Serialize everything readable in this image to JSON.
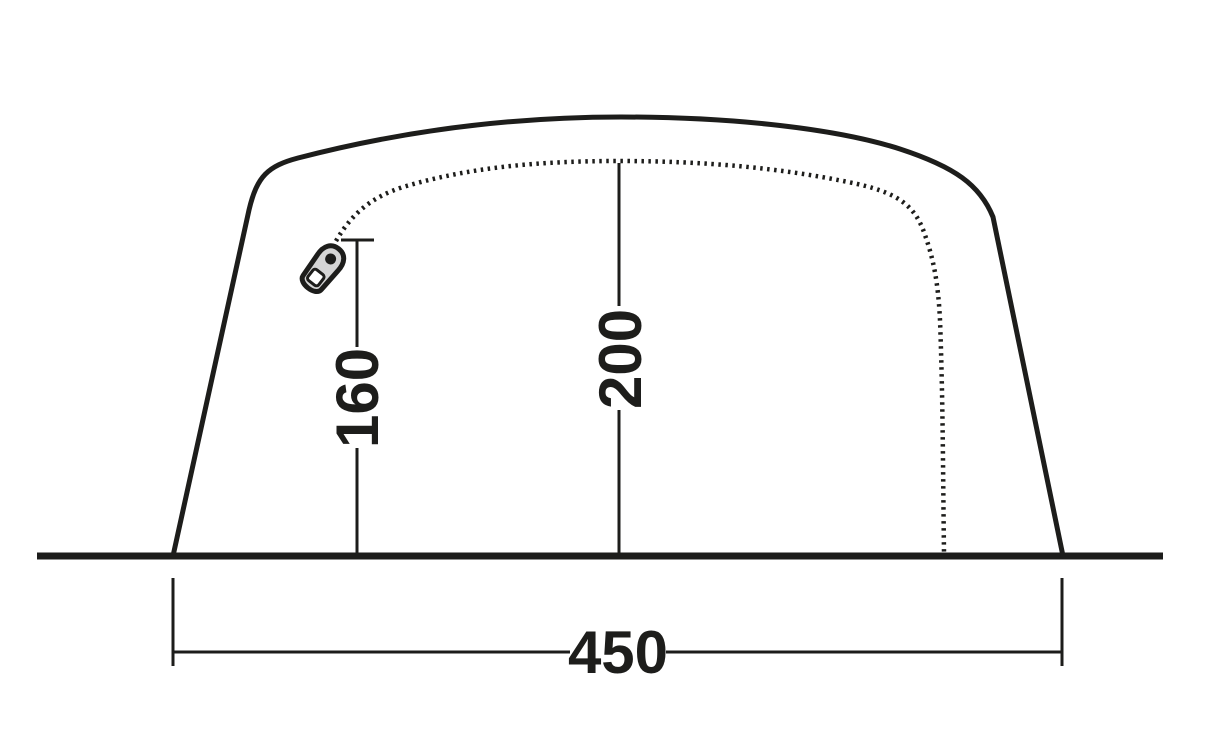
{
  "diagram": {
    "subject": "tent side profile with dimensions",
    "dimensions": {
      "zip_height": {
        "label": "160"
      },
      "center_height": {
        "label": "200"
      },
      "base_width": {
        "label": "450"
      }
    },
    "icons": {
      "zipper_pull": "zipper-pull-icon"
    },
    "colors": {
      "line": "#1d1d1b",
      "background": "#ffffff",
      "zipper_fill": "#d5d5d5"
    }
  }
}
